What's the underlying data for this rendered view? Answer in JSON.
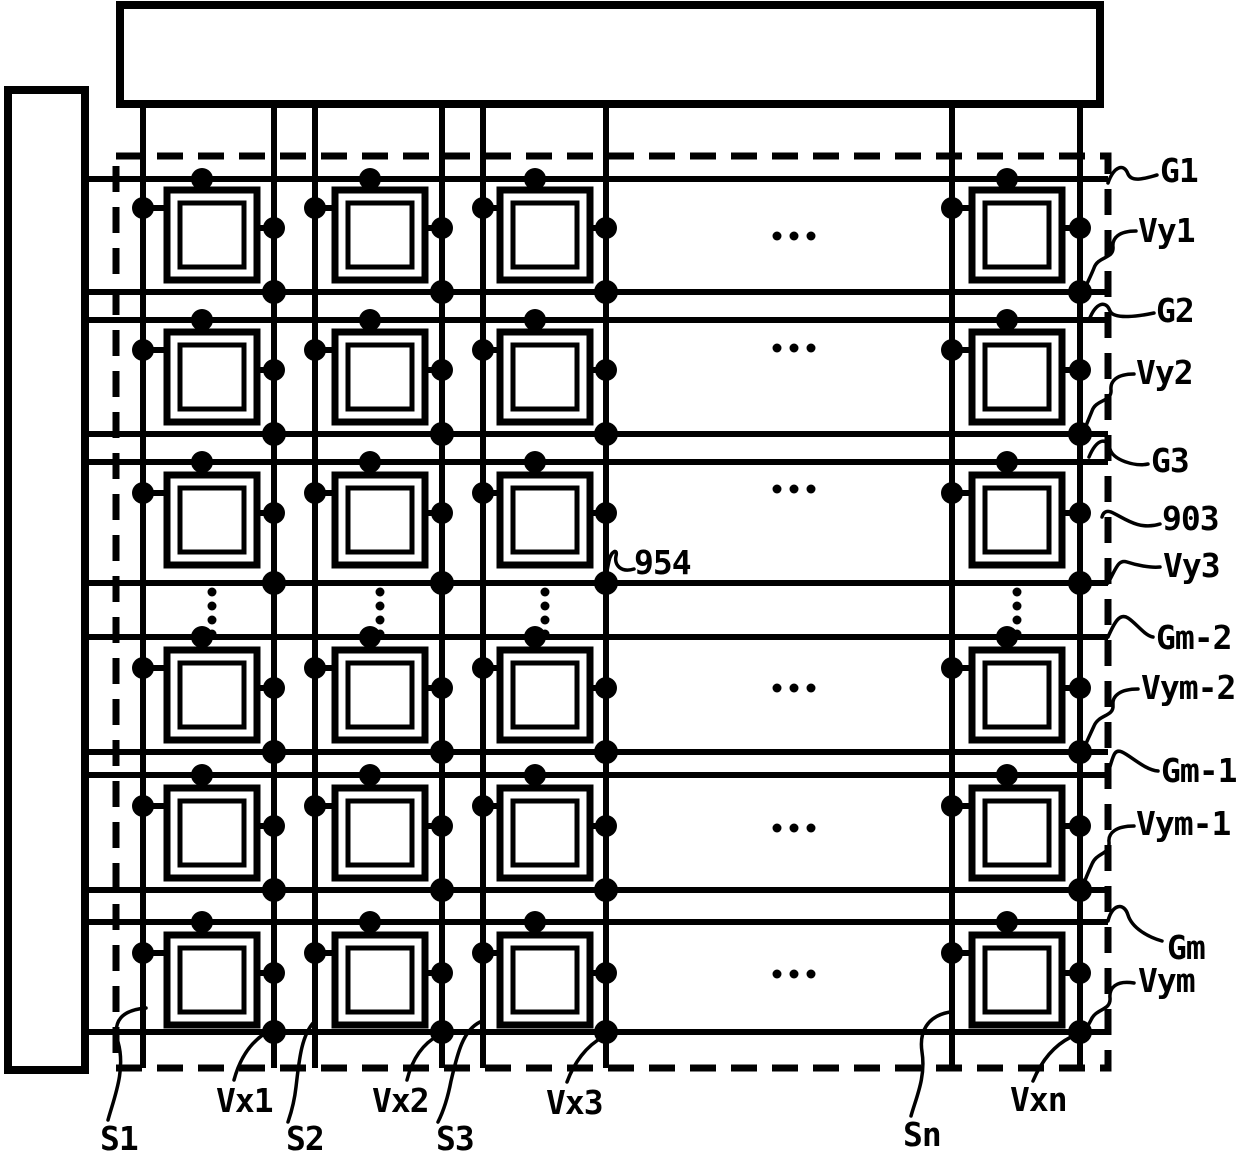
{
  "figure": {
    "labels": {
      "gate_lines": [
        "G1",
        "G2",
        "G3",
        "Gm-2",
        "Gm-1",
        "Gm"
      ],
      "vy_lines": [
        "Vy1",
        "Vy2",
        "Vy3",
        "Vym-2",
        "Vym-1",
        "Vym"
      ],
      "source_lines": [
        "S1",
        "S2",
        "S3",
        "Sn"
      ],
      "vx_lines": [
        "Vx1",
        "Vx2",
        "Vx3",
        "Vxn"
      ],
      "refs": {
        "array_boundary": "903",
        "pixel_contact": "954"
      }
    }
  }
}
